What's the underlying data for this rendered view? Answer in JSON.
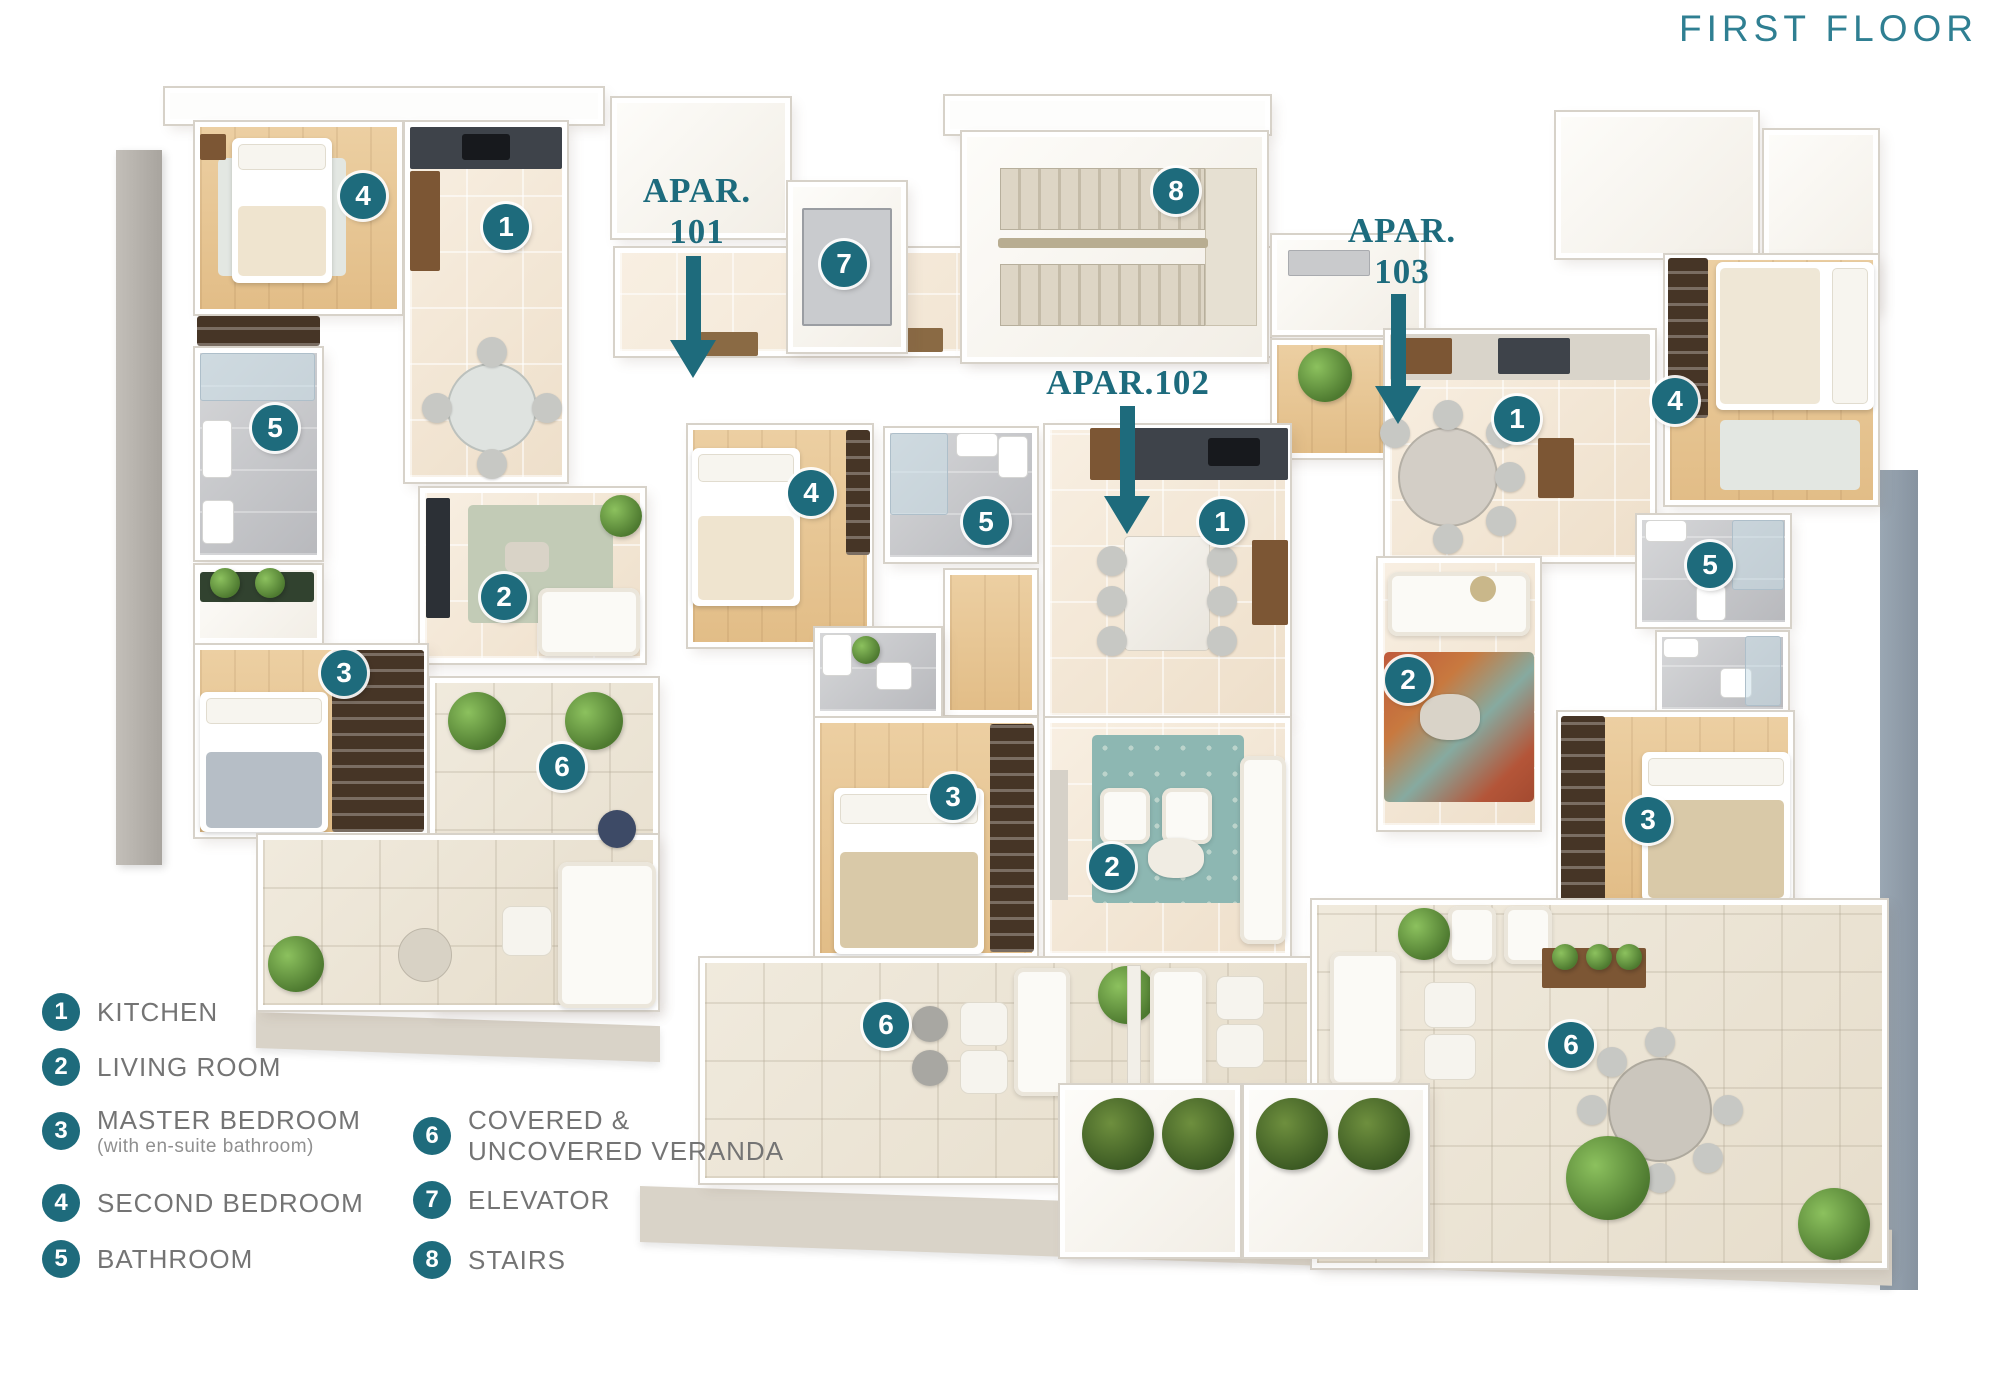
{
  "title": "FIRST FLOOR",
  "apartment_labels": [
    {
      "id": "101",
      "lines": [
        "APAR.",
        "101"
      ]
    },
    {
      "id": "102",
      "lines": [
        "APAR.102"
      ]
    },
    {
      "id": "103",
      "lines": [
        "APAR.",
        "103"
      ]
    }
  ],
  "markers": [
    {
      "apartment": "101",
      "room": "second-bedroom",
      "number": "4"
    },
    {
      "apartment": "101",
      "room": "kitchen",
      "number": "1"
    },
    {
      "apartment": "101",
      "room": "bathroom",
      "number": "5"
    },
    {
      "apartment": "101",
      "room": "living-room",
      "number": "2"
    },
    {
      "apartment": "101",
      "room": "master-bedroom",
      "number": "3"
    },
    {
      "apartment": "101",
      "room": "veranda",
      "number": "6"
    },
    {
      "apartment": "common",
      "room": "elevator",
      "number": "7"
    },
    {
      "apartment": "common",
      "room": "stairs",
      "number": "8"
    },
    {
      "apartment": "102",
      "room": "second-bedroom",
      "number": "4"
    },
    {
      "apartment": "102",
      "room": "bathroom",
      "number": "5"
    },
    {
      "apartment": "102",
      "room": "kitchen",
      "number": "1"
    },
    {
      "apartment": "102",
      "room": "master-bedroom",
      "number": "3"
    },
    {
      "apartment": "102",
      "room": "living-room",
      "number": "2"
    },
    {
      "apartment": "102",
      "room": "veranda",
      "number": "6"
    },
    {
      "apartment": "103",
      "room": "kitchen",
      "number": "1"
    },
    {
      "apartment": "103",
      "room": "second-bedroom",
      "number": "4"
    },
    {
      "apartment": "103",
      "room": "bathroom",
      "number": "5"
    },
    {
      "apartment": "103",
      "room": "living-room",
      "number": "2"
    },
    {
      "apartment": "103",
      "room": "master-bedroom",
      "number": "3"
    },
    {
      "apartment": "103",
      "room": "veranda",
      "number": "6"
    }
  ],
  "legend": {
    "items": [
      {
        "number": "1",
        "label": "KITCHEN"
      },
      {
        "number": "2",
        "label": "LIVING ROOM"
      },
      {
        "number": "3",
        "label": "MASTER BEDROOM",
        "sublabel": "(with en-suite bathroom)"
      },
      {
        "number": "4",
        "label": "SECOND BEDROOM"
      },
      {
        "number": "5",
        "label": "BATHROOM"
      },
      {
        "number": "6",
        "label": "COVERED &",
        "label2": "UNCOVERED VERANDA"
      },
      {
        "number": "7",
        "label": "ELEVATOR"
      },
      {
        "number": "8",
        "label": "STAIRS"
      }
    ]
  },
  "colors": {
    "accent_teal": "#1e6b7c",
    "title_teal": "#2f7f92",
    "legend_text_gray": "#747474",
    "legend_subtext_gray": "#8f8f8f"
  }
}
